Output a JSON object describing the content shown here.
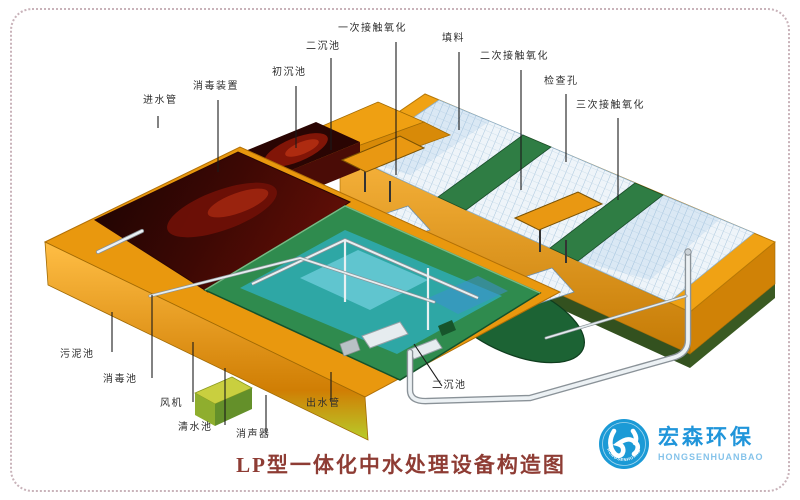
{
  "title": {
    "text": "LP型一体化中水处理设备构造图",
    "color": "#8e3c34"
  },
  "logo": {
    "cn": "宏森环保",
    "en": "HONGSENHUANBAO",
    "circle_text": "HONGSENHUANBAO",
    "blue": "#1b9ad6",
    "light_blue": "#85c3ea"
  },
  "callouts": [
    {
      "id": "inlet-pipe",
      "text": "进水管"
    },
    {
      "id": "disinfection-device",
      "text": "消毒装置"
    },
    {
      "id": "primary-sedimentation-tank",
      "text": "初沉池"
    },
    {
      "id": "secondary-sedimentation-tank-top",
      "text": "二沉池"
    },
    {
      "id": "first-contact-oxidation",
      "text": "一次接触氧化"
    },
    {
      "id": "packing-media",
      "text": "填料"
    },
    {
      "id": "second-contact-oxidation",
      "text": "二次接触氧化"
    },
    {
      "id": "inspection-hole",
      "text": "检查孔"
    },
    {
      "id": "third-contact-oxidation",
      "text": "三次接触氧化"
    },
    {
      "id": "sludge-tank",
      "text": "污泥池"
    },
    {
      "id": "disinfection-tank",
      "text": "消毒池"
    },
    {
      "id": "blower",
      "text": "风机"
    },
    {
      "id": "clean-water-tank",
      "text": "清水池"
    },
    {
      "id": "silencer",
      "text": "消声器"
    },
    {
      "id": "outlet-pipe",
      "text": "出水管"
    },
    {
      "id": "secondary-sedimentation-tank",
      "text": "二沉池"
    }
  ],
  "palette": {
    "shell_orange": "#e9980e",
    "shell_orange_light": "#f7b33c",
    "shell_orange_dark": "#c97b06",
    "tank_green": "#2f8b4e",
    "tank_green_dark": "#1c6334",
    "water_teal": "#2da6a4",
    "cavity_maroon": "#4a0c06",
    "cavity_red": "#a62810",
    "packing_white": "#eef4f9",
    "packing_grid_blue": "#a9c6dd",
    "leader_line": "#1b1b1b",
    "border_dots": "#c9b3ba"
  }
}
